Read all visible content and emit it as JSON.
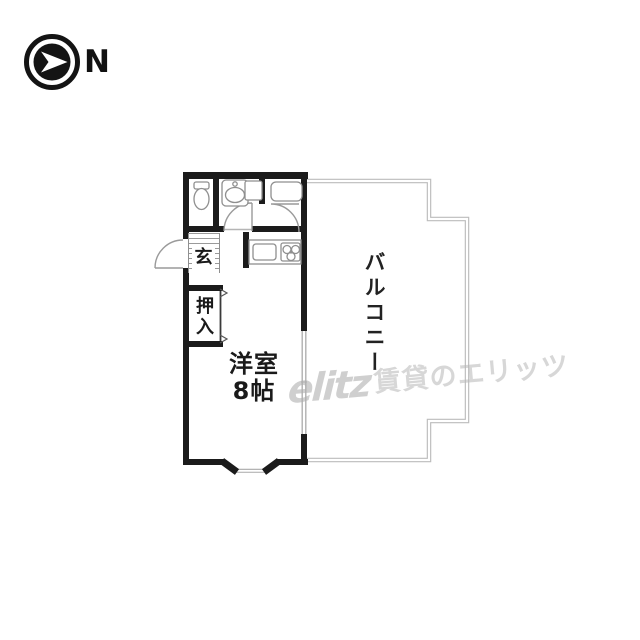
{
  "compass": {
    "label": "N"
  },
  "rooms": {
    "genkan": "玄",
    "closet": "押入",
    "room": "洋室",
    "room_size": "8帖",
    "balcony": "バルコニー"
  },
  "watermark": {
    "logo": "elitz",
    "text": "賃貸のエリッツ"
  },
  "colors": {
    "wall": "#1b1b1b",
    "fixture": "#8f8f8f",
    "balcony_outline": "#bcbcbc",
    "watermark": "#b6b6b6"
  }
}
